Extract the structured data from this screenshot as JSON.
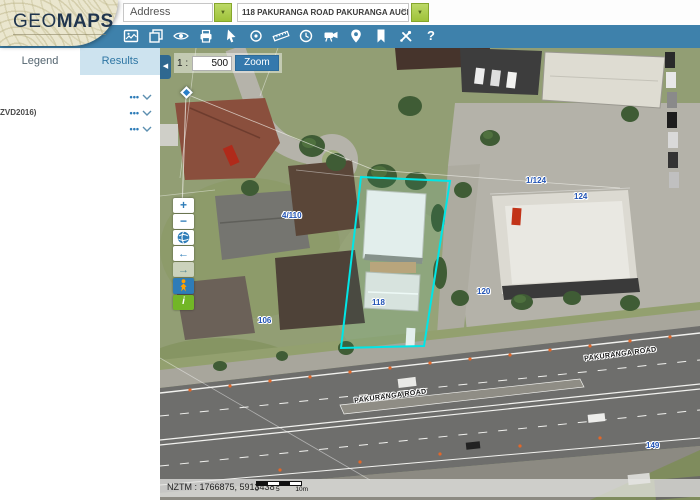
{
  "header": {
    "logo": {
      "geo": "GEO",
      "maps": "MAPS"
    },
    "search_type_value": "Address",
    "search_query_value": "118 PAKURANGA ROAD PAKURANGA AUCKLAND 2010",
    "clear_icon": "×",
    "dropdown_arrow": "▼"
  },
  "toolbar": {
    "icons": [
      "basemap",
      "layers",
      "visibility",
      "print",
      "pointer",
      "identify",
      "measure",
      "history",
      "streetview",
      "locate",
      "bookmark",
      "tools",
      "help"
    ],
    "help_label": "?"
  },
  "sidebar": {
    "tabs": [
      {
        "label": "Legend"
      },
      {
        "label": "Results"
      }
    ],
    "rows": [
      {
        "label": ""
      },
      {
        "label": "ZVD2016)"
      },
      {
        "label": ""
      }
    ],
    "menu_dots": "•••"
  },
  "map": {
    "collapse_arrow": "◀",
    "scale_prefix": "1 :",
    "scale_value": "500",
    "zoom_button_label": "Zoom",
    "coords": "NZTM : 1766875, 5913438",
    "scalebar_labels": [
      "0",
      "5",
      "10m"
    ],
    "road_label_1": "PAKURANGA ROAD",
    "road_label_2": "PAKURANGA ROAD",
    "parcel_labels": {
      "l4_110": "4/110",
      "l1_124": "1/124",
      "l124": "124",
      "l120": "120",
      "l118": "118",
      "l106": "106",
      "l149": "149"
    },
    "highlight_color": "#00e6e6"
  },
  "controls": {
    "zoom_in": "+",
    "zoom_out": "−",
    "back_arrow": "←",
    "forward_arrow": "→",
    "info": "i"
  },
  "colors": {
    "toolbar_blue": "#3e81ab",
    "dropdown_green": "#9fc23a",
    "control_blue": "#2e7cb8",
    "info_green": "#72b626",
    "label_blue": "#2153b5"
  }
}
